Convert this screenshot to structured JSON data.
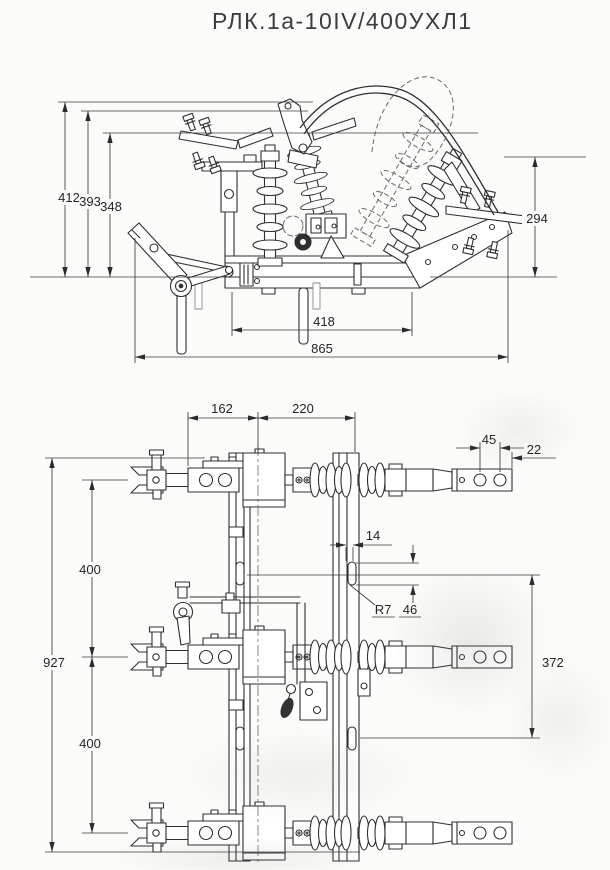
{
  "title": "РЛК.1а-10IV/400УХЛ1",
  "front_view": {
    "dims": {
      "overall_height": "412",
      "mid_height": "393",
      "terminal_height": "348",
      "right_height": "294",
      "base_length": "418",
      "overall_width": "865"
    }
  },
  "plan_view": {
    "dims": {
      "arm_offset": "162",
      "rail_span": "220",
      "hole_spacing": "45",
      "hole_edge_offset": "22",
      "overall_height": "927",
      "phase_pitch_upper": "400",
      "phase_pitch_lower": "400",
      "slot_width": "14",
      "slot_radius": "R7",
      "slot_length": "46",
      "slot_pitch": "372"
    }
  }
}
